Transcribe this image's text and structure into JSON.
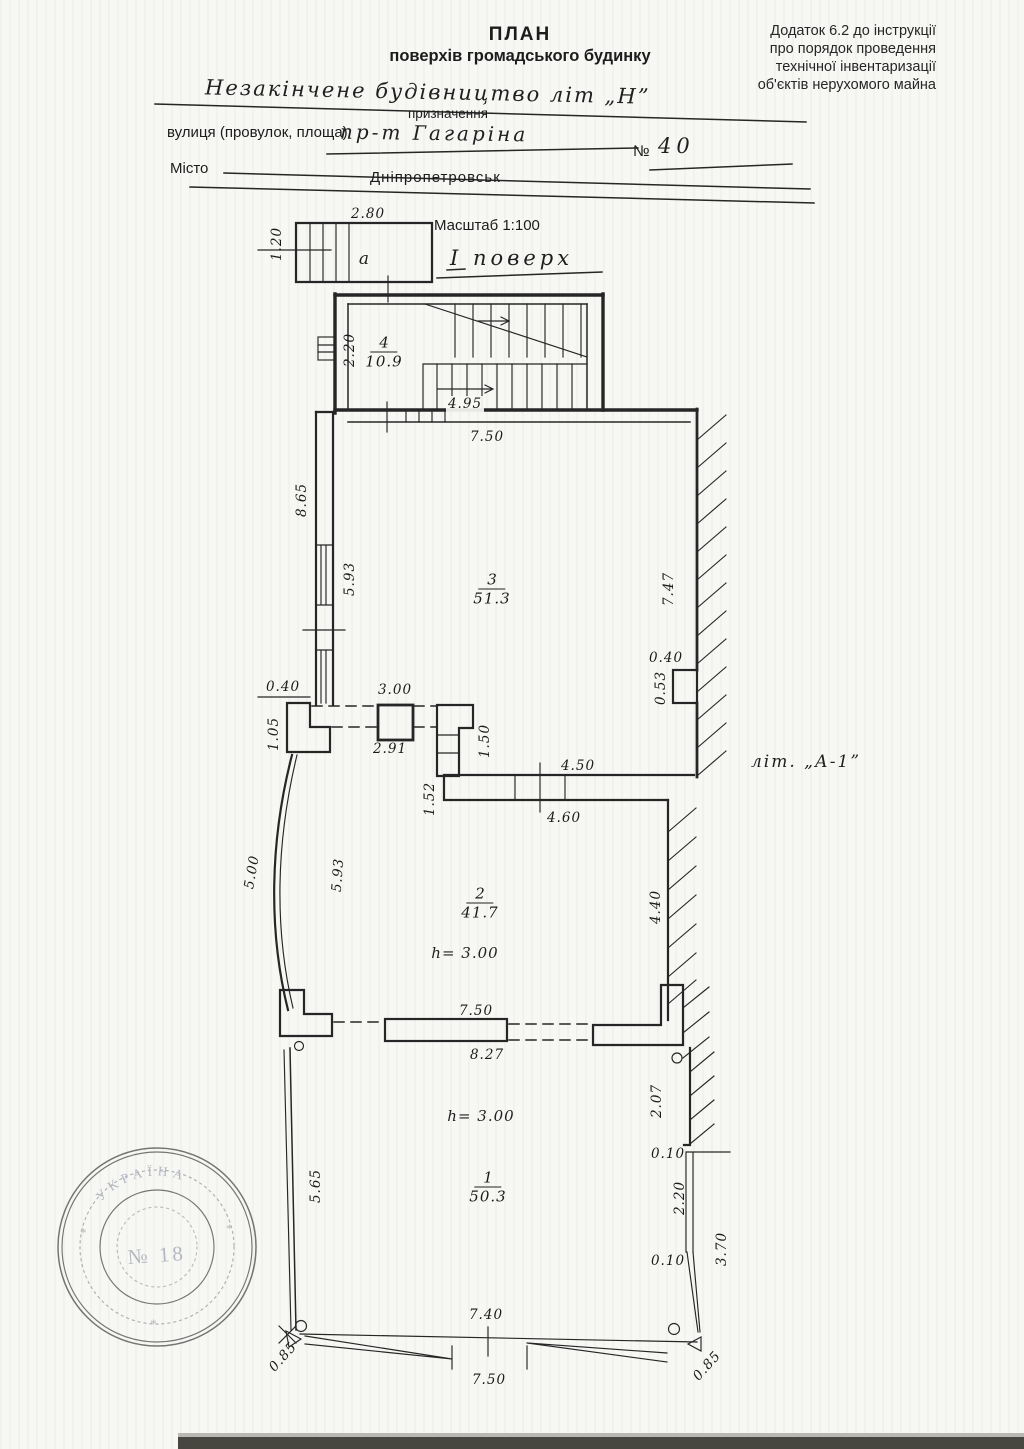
{
  "header": {
    "annex": [
      "Додаток 6.2 до інструкції",
      "про порядок проведення",
      "технічної інвентаризації",
      "об'єктів нерухомого майна"
    ],
    "title": "ПЛАН",
    "subtitle": "поверхів громадського будинку",
    "purpose_value": "Незакінчене будівництво літ „Н”",
    "purpose_caption": "призначення",
    "street_label": "вулиця (провулок, площа)",
    "street_value": "пр-т Гагаріна",
    "number_sign": "№",
    "number_value": "40",
    "city_label": "Місто",
    "city_value": "Дніпропетровськ"
  },
  "plan": {
    "scale_label": "Масштаб 1:100",
    "floor_label": "І поверх",
    "building_letter": "літ. „А-1”",
    "room_a_label": "a",
    "stair_room": {
      "num": "4",
      "area": "10.9"
    },
    "room3": {
      "num": "3",
      "area": "51.3"
    },
    "room2": {
      "num": "2",
      "area": "41.7",
      "height": "h= 3.00"
    },
    "room1": {
      "num": "1",
      "area": "50.3",
      "height": "h= 3.00"
    },
    "dims": {
      "a_width": "2.80",
      "a_height": "1.20",
      "stair_width": "2.20",
      "stair_run": "4.95",
      "below_stairs": "7.50",
      "west_upper": "8.65",
      "west_mid": "5.93",
      "east_upper": "7.47",
      "pilaster_w": "0.40",
      "pilaster_h": "0.53",
      "pier_w": "0.40",
      "pier_h": "1.05",
      "col_span_top": "3.00",
      "col_span_bottom": "2.91",
      "pier_right_h": "1.50",
      "wall_left_h": "1.52",
      "wall_top": "4.50",
      "wall_bottom": "4.60",
      "arc_outer": "5.00",
      "arc_inner": "5.93",
      "room2_east": "4.40",
      "divider_top": "7.50",
      "divider_bottom": "8.27",
      "room1_east_a": "2.07",
      "step_a": "0.10",
      "window_east": "2.20",
      "east_lower": "3.70",
      "step_b": "0.10",
      "room1_west": "5.65",
      "bottom_top": "7.40",
      "bottom_bottom": "7.50",
      "corner_left": "0.85",
      "corner_right": "0.85"
    }
  },
  "stamp": {
    "country": "УКРАЇНА",
    "number": "№ 18",
    "star": "*"
  }
}
